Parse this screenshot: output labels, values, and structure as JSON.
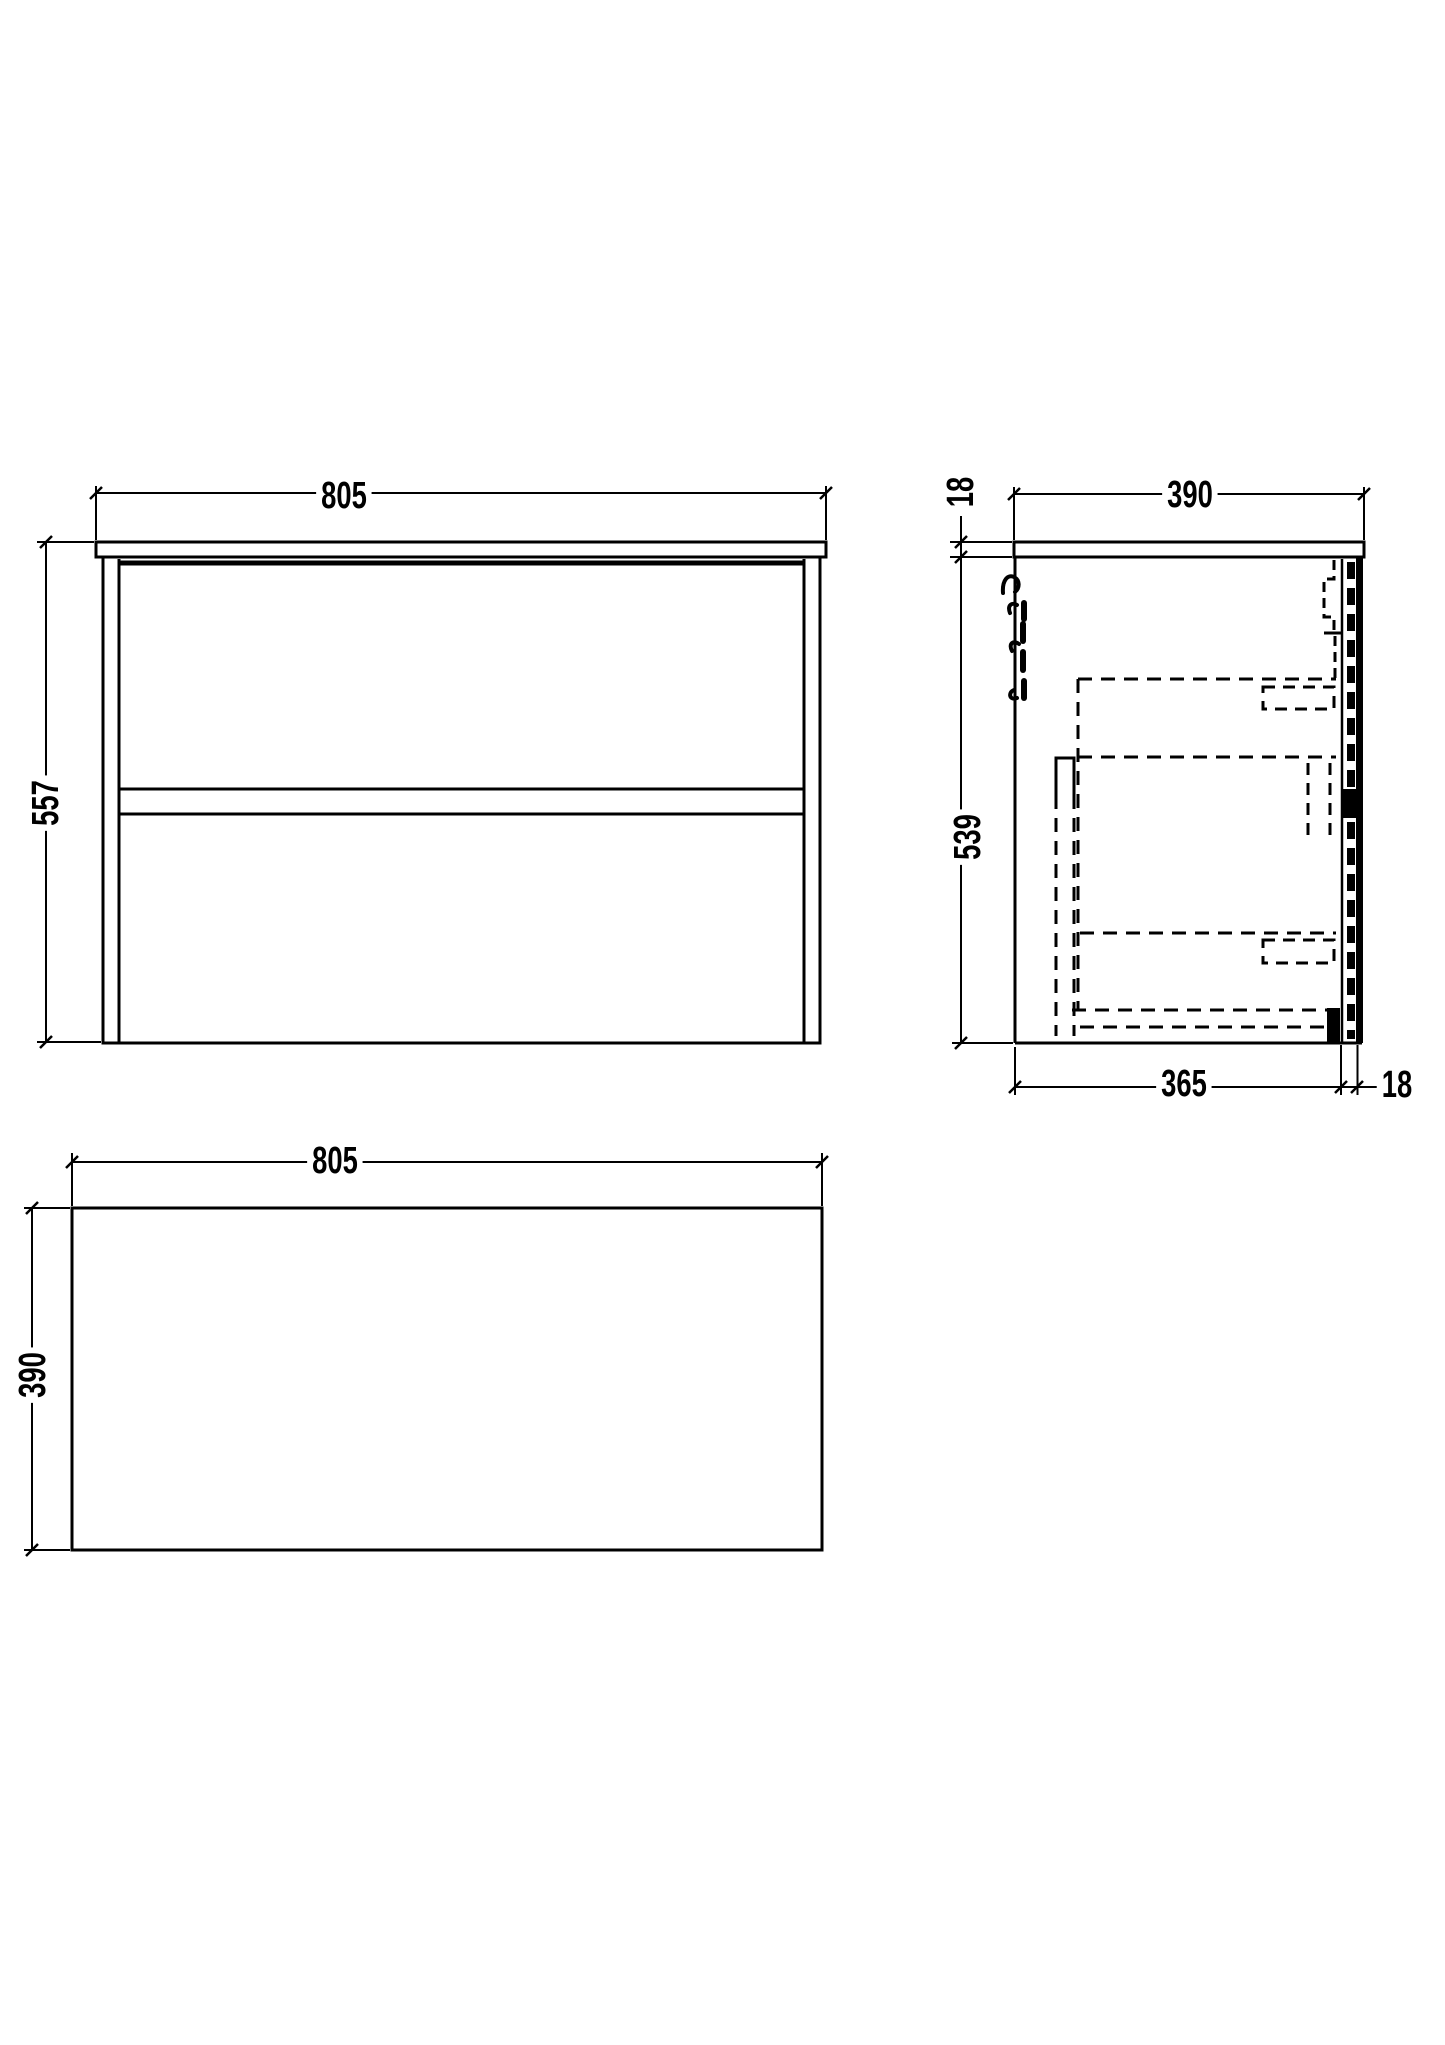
{
  "drawing": {
    "front_view": {
      "width": "805",
      "height": "557"
    },
    "side_view": {
      "top_thickness": "18",
      "depth": "390",
      "height": "539",
      "body_depth": "365",
      "back_panel_thickness": "18"
    },
    "plan_view": {
      "width": "805",
      "depth": "390"
    }
  },
  "colors": {
    "line": "#000000",
    "background": "#ffffff"
  }
}
